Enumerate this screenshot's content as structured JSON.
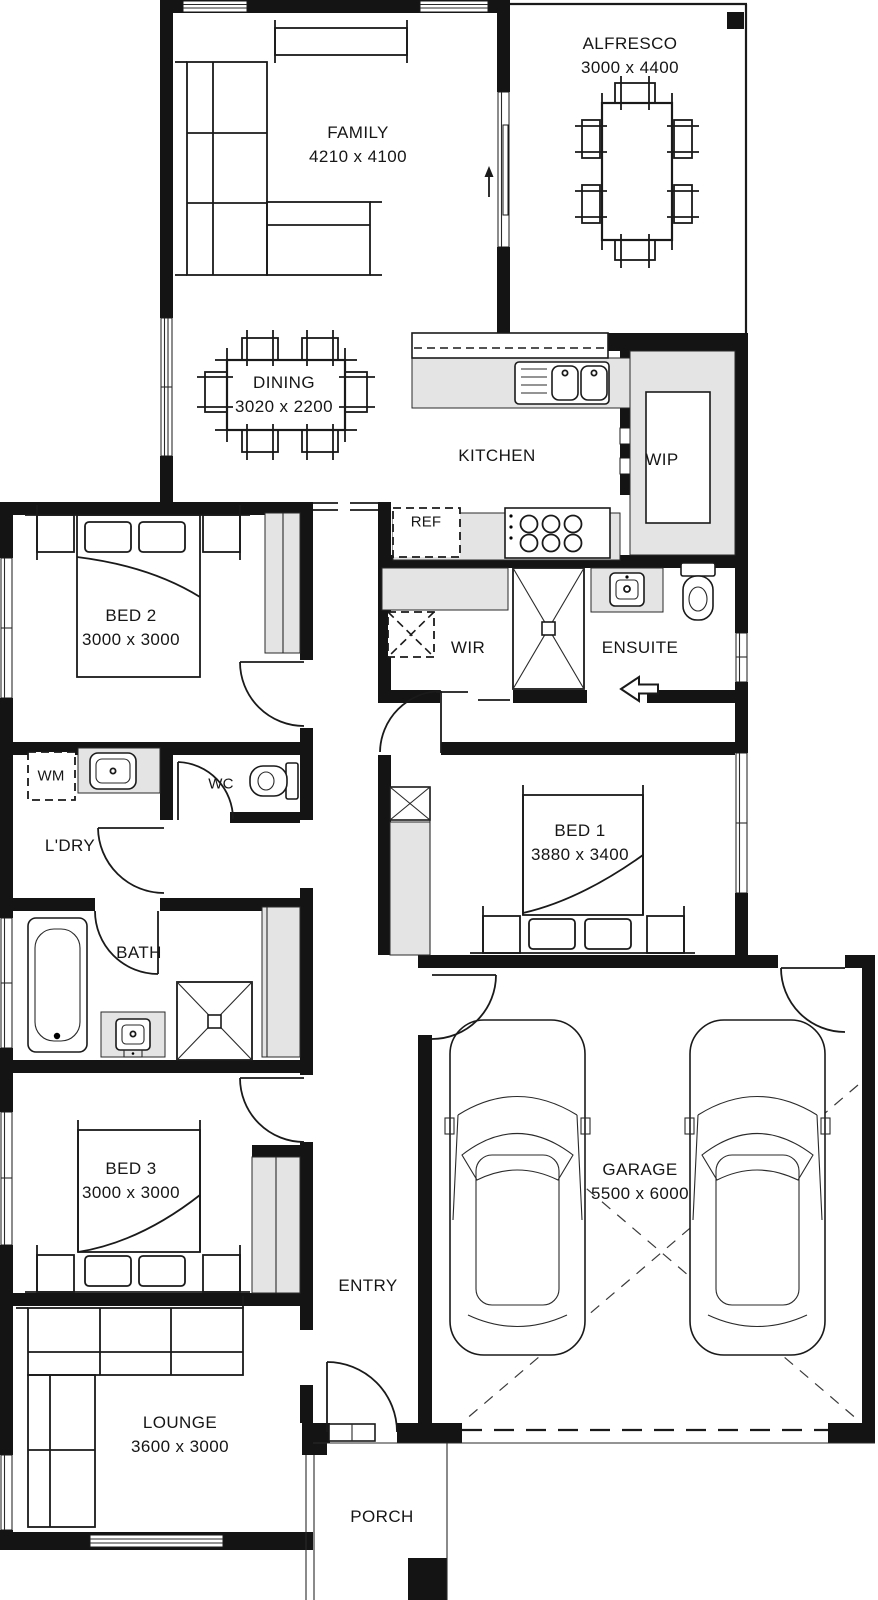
{
  "title": "Single storey house floor plan",
  "colors": {
    "wall": "#141414",
    "fixture": "#e4e4e4",
    "line": "#1a1a1a",
    "background": "#ffffff"
  },
  "rooms": [
    {
      "id": "family",
      "label": "FAMILY",
      "dims": "4210 x 4100"
    },
    {
      "id": "alfresco",
      "label": "ALFRESCO",
      "dims": "3000 x 4400"
    },
    {
      "id": "dining",
      "label": "DINING",
      "dims": "3020 x 2200"
    },
    {
      "id": "kitchen",
      "label": "KITCHEN",
      "dims": ""
    },
    {
      "id": "wip",
      "label": "WIP",
      "dims": ""
    },
    {
      "id": "ref",
      "label": "REF",
      "dims": ""
    },
    {
      "id": "bed2",
      "label": "BED 2",
      "dims": "3000 x 3000"
    },
    {
      "id": "wir",
      "label": "WIR",
      "dims": ""
    },
    {
      "id": "ensuite",
      "label": "ENSUITE",
      "dims": ""
    },
    {
      "id": "wm",
      "label": "WM",
      "dims": ""
    },
    {
      "id": "wc",
      "label": "WC",
      "dims": ""
    },
    {
      "id": "ldry",
      "label": "L'DRY",
      "dims": ""
    },
    {
      "id": "bed1",
      "label": "BED 1",
      "dims": "3880 x 3400"
    },
    {
      "id": "bath",
      "label": "BATH",
      "dims": ""
    },
    {
      "id": "bed3",
      "label": "BED 3",
      "dims": "3000 x 3000"
    },
    {
      "id": "entry",
      "label": "ENTRY",
      "dims": ""
    },
    {
      "id": "garage",
      "label": "GARAGE",
      "dims": "5500 x 6000"
    },
    {
      "id": "lounge",
      "label": "LOUNGE",
      "dims": "3600 x 3000"
    },
    {
      "id": "porch",
      "label": "PORCH",
      "dims": ""
    }
  ],
  "icons": {
    "alfresco_door_direction": "up-arrow",
    "ensuite_entry_direction": "left-arrow"
  }
}
